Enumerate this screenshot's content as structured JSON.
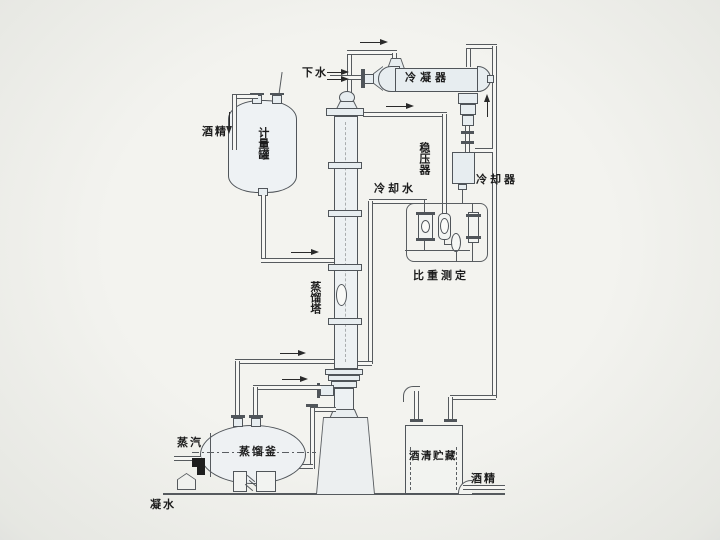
{
  "meta": {
    "type": "process-flow-diagram",
    "subject": "alcohol distillation system",
    "language": "zh"
  },
  "colors": {
    "background": "#efefeb",
    "line": "#565a5e",
    "vessel_fill": "#e7edf0",
    "pipe_fill": "#f6f6f3",
    "text": "#1c1c1c",
    "arrow": "#2a2a2a",
    "valve_black": "#1e1e1e"
  },
  "labels": {
    "drain_water": "下水",
    "condenser": "冷凝器",
    "pressure_stabilizer": "稳压器",
    "cooler": "冷却器",
    "cooling_water": "冷却水",
    "density_measurement": "比重测定",
    "alcohol_feed": "酒精",
    "metering_tank": "计量罐",
    "distillation_column": "蒸馏塔",
    "steam": "蒸汽",
    "distillation_kettle": "蒸馏釜",
    "condensate": "凝水",
    "alcohol_storage": "酒清贮藏",
    "alcohol_product": "酒精"
  },
  "flow_arrows": [
    {
      "location": "column-top-to-condenser",
      "direction": "right"
    },
    {
      "location": "drain-water-inlet",
      "direction": "right",
      "count": 2
    },
    {
      "location": "condenser-right-downpipe",
      "direction": "up"
    },
    {
      "location": "column-plate-to-measurement",
      "direction": "right"
    },
    {
      "location": "alcohol-feed-into-metering-tank",
      "direction": "down"
    },
    {
      "location": "metering-tank-to-column-feed",
      "direction": "right"
    },
    {
      "location": "kettle-vapor-to-column",
      "direction": "right"
    },
    {
      "location": "kettle-return-line",
      "direction": "right"
    }
  ]
}
